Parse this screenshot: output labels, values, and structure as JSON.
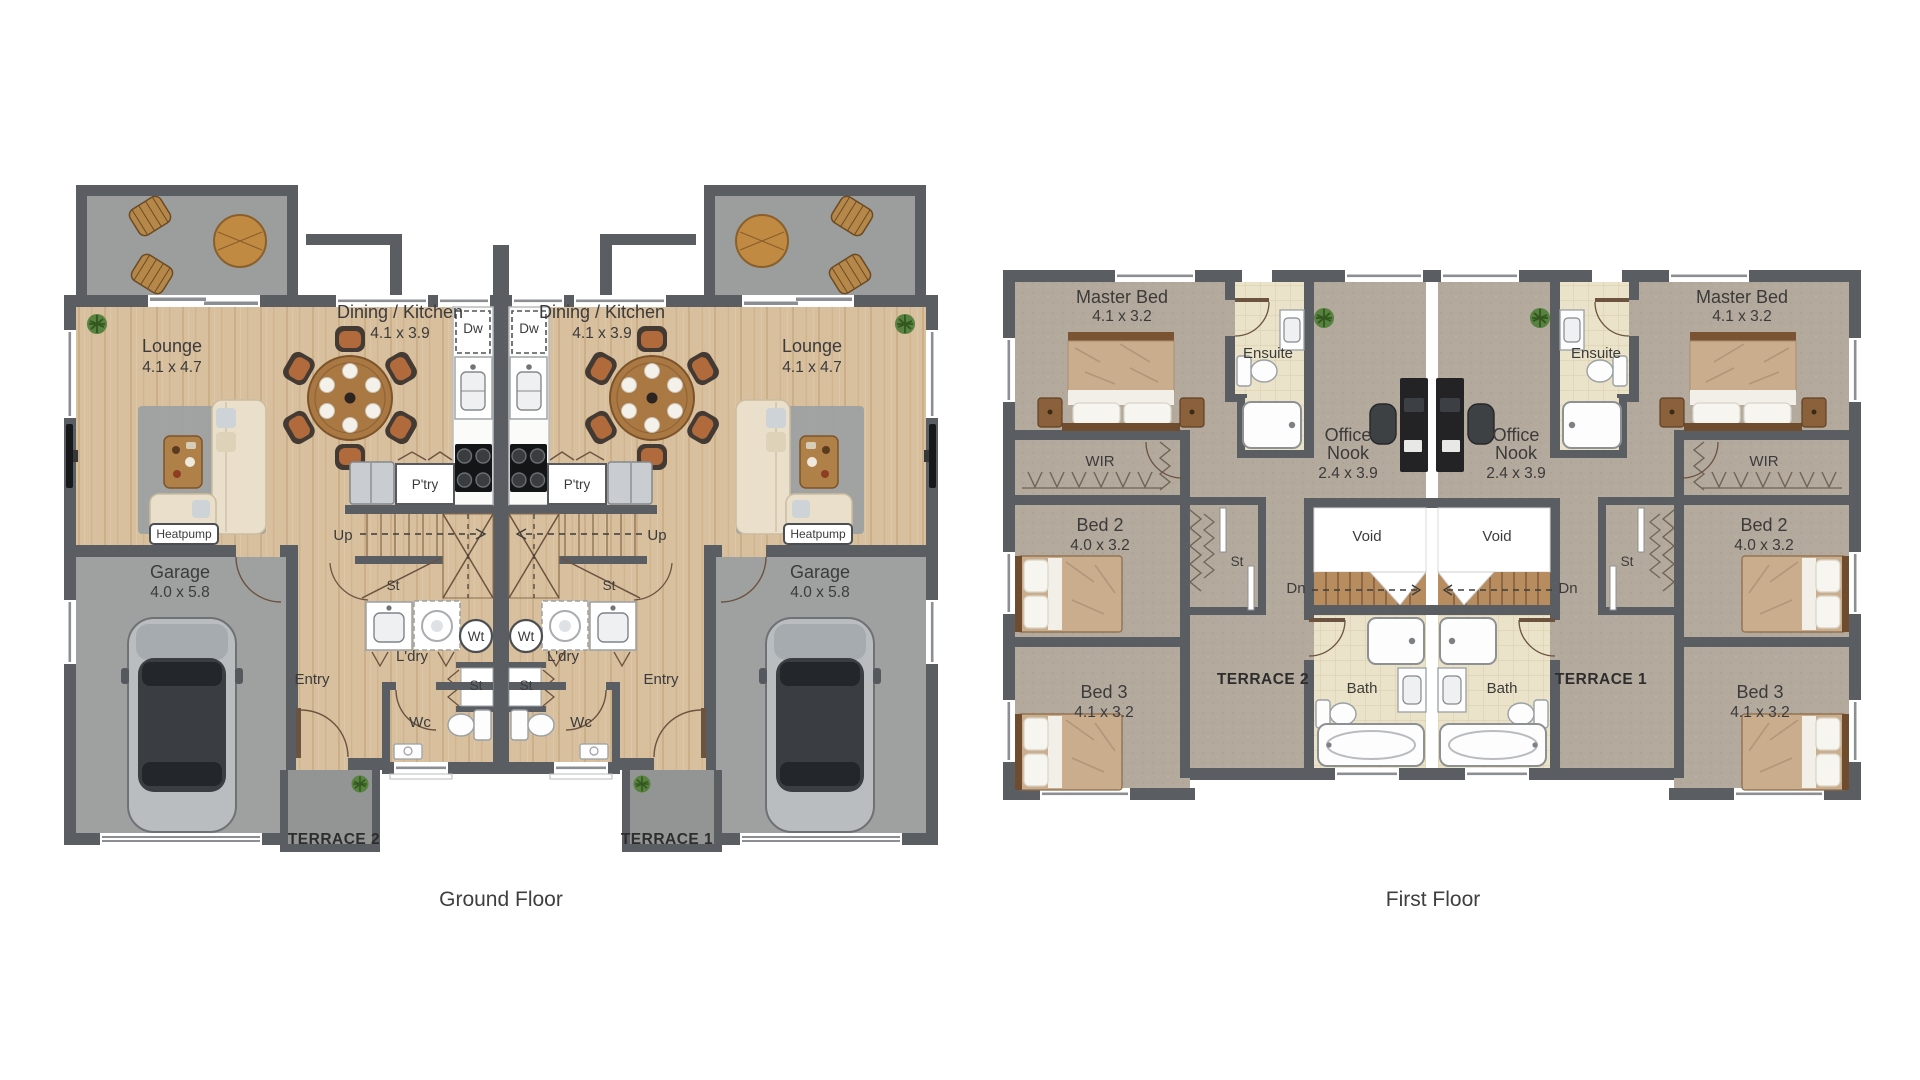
{
  "captions": {
    "ground_floor": "Ground Floor",
    "first_floor": "First Floor"
  },
  "ground_floor": {
    "unit_left": {
      "lounge_name": "Lounge",
      "lounge_dims": "4.1 x 4.7",
      "dining_name": "Dining / Kitchen",
      "dining_dims": "4.1 x 3.9",
      "garage_name": "Garage",
      "garage_dims": "4.0 x 5.8",
      "entry": "Entry",
      "wc": "Wc",
      "laundry": "L'dry",
      "pantry": "P'try",
      "dishwasher": "Dw",
      "washtub": "Wt",
      "storage_under_stair": "St",
      "storage_closet": "St",
      "stairs_up": "Up",
      "heatpump": "Heatpump",
      "terrace": "TERRACE 2"
    },
    "unit_right": {
      "lounge_name": "Lounge",
      "lounge_dims": "4.1 x 4.7",
      "dining_name": "Dining / Kitchen",
      "dining_dims": "4.1 x 3.9",
      "garage_name": "Garage",
      "garage_dims": "4.0 x 5.8",
      "entry": "Entry",
      "wc": "Wc",
      "laundry": "L'dry",
      "pantry": "P'try",
      "dishwasher": "Dw",
      "washtub": "Wt",
      "storage_under_stair": "St",
      "storage_closet": "St",
      "stairs_up": "Up",
      "heatpump": "Heatpump",
      "terrace": "TERRACE 1"
    }
  },
  "first_floor": {
    "unit_left": {
      "master_name": "Master Bed",
      "master_dims": "4.1 x 3.2",
      "ensuite": "Ensuite",
      "wir": "WIR",
      "office_line1": "Office",
      "office_line2": "Nook",
      "office_dims": "2.4 x 3.9",
      "bed2_name": "Bed 2",
      "bed2_dims": "4.0 x 3.2",
      "bed3_name": "Bed 3",
      "bed3_dims": "4.1 x 3.2",
      "bath": "Bath",
      "void": "Void",
      "stairs_dn": "Dn",
      "linen": "St",
      "terrace": "TERRACE 2"
    },
    "unit_right": {
      "master_name": "Master Bed",
      "master_dims": "4.1 x 3.2",
      "ensuite": "Ensuite",
      "wir": "WIR",
      "office_line1": "Office",
      "office_line2": "Nook",
      "office_dims": "2.4 x 3.9",
      "bed2_name": "Bed 2",
      "bed2_dims": "4.0 x 3.2",
      "bed3_name": "Bed 3",
      "bed3_dims": "4.1 x 3.2",
      "bath": "Bath",
      "void": "Void",
      "stairs_dn": "Dn",
      "linen": "St",
      "terrace": "TERRACE 1"
    }
  },
  "colors": {
    "wall": "#5a5e62",
    "wood_floor": "#d8bf9e",
    "carpet": "#b3a99c",
    "concrete": "#9c9e9d",
    "terrace_concrete": "#929594",
    "tile": "#eae3c9",
    "fixture_white": "#fdfdfd",
    "door": "#6b5340",
    "text": "#3b3b3b",
    "duvet": "#c9ad8d",
    "bed_frame": "#6f4c2d",
    "table_wood": "#aa7843",
    "chair_accent": "#b06a3b",
    "rug": "#9ba1a2",
    "plant": "#57823f"
  }
}
